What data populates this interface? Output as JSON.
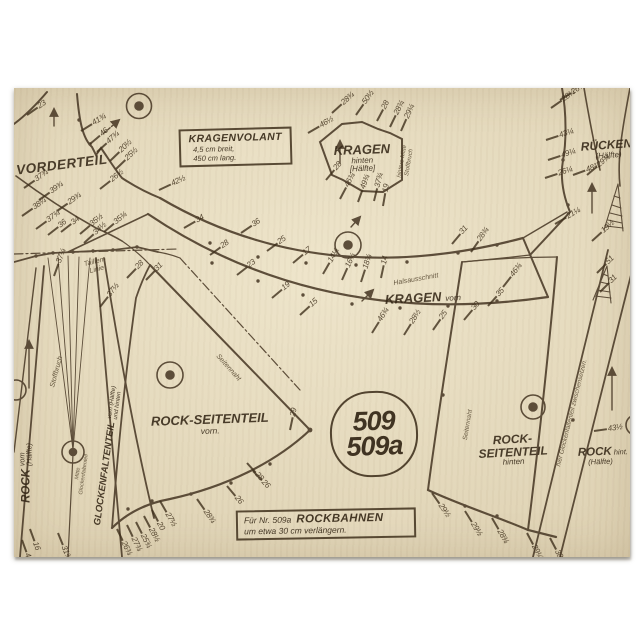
{
  "colors": {
    "paper": "#e7dcbd",
    "ink": "#4e3e2b"
  },
  "sheet": {
    "pattern_number": {
      "line1": "509",
      "line2": "509a"
    },
    "boxes": {
      "kragenvolant": {
        "title": "KRAGENVOLANT",
        "line1": "4,5 cm breit,",
        "line2": "450 cm lang."
      },
      "rockbahnen": {
        "prefix": "Für Nr. 509a",
        "title": "ROCKBAHNEN",
        "line2": "um etwa 30 cm verlängern."
      }
    },
    "pieces": {
      "vorderteil": {
        "label": "VORDERTEIL"
      },
      "kragen_hinten": {
        "label": "KRAGEN",
        "sub1": "hinten",
        "sub2": "[Hälfte]"
      },
      "kragen_vorn": {
        "label": "KRAGEN",
        "sub": "vorn"
      },
      "rueckenteil": {
        "label": "RÜCKENTEIL",
        "sub": "(Hälfte)"
      },
      "rock_seitenteil_vorn": {
        "label": "ROCK-SEITENTEIL",
        "sub": "vorn."
      },
      "rock_seitenteil_hinten": {
        "line1": "ROCK-",
        "line2": "SEITENTEIL",
        "sub": "hinten"
      },
      "rock_vorn": {
        "label": "ROCK",
        "sub1": "vorn",
        "sub2": "(Hälfte)"
      },
      "rock_hinten": {
        "label": "ROCK",
        "sub1": "hint.",
        "sub2": "(Hälfte)"
      },
      "glockenfaltenteil": {
        "label": "GLOCKENFALTENTEIL",
        "sub1": "vorn (Hälfte)",
        "sub2": "und hinten"
      }
    },
    "annotations": {
      "taillen_linie1": "Taillen-",
      "taillen_linie2": "Linie",
      "halsausschnitt": "Halsausschnitt",
      "stoffbruch": "Stoffbruch",
      "seitennaht_vorn": "Seitennaht",
      "seitennaht_hinten": "Seitennaht",
      "hintere_mitte1": "hintere Mitte",
      "hintere_mitte2": "Stoffbruch",
      "zwischensetzen": "hier Glockenfaltenteil zwischensetzen.",
      "mitte_glocke1": "Mitte",
      "mitte_glocke2": "Glockenfaltenteil"
    },
    "measure_marks": [
      [
        27,
        111,
        -35,
        "23"
      ],
      [
        81,
        127,
        -32,
        "41¾"
      ],
      [
        90,
        140,
        -40,
        "46"
      ],
      [
        97,
        148,
        -42,
        "47¾"
      ],
      [
        110,
        157,
        -44,
        "20½"
      ],
      [
        116,
        165,
        -44,
        "25½"
      ],
      [
        100,
        185,
        -38,
        "26½"
      ],
      [
        24,
        184,
        -35,
        "37¾"
      ],
      [
        39,
        196,
        -35,
        "39¾"
      ],
      [
        57,
        207,
        -35,
        "29¾"
      ],
      [
        22,
        212,
        -35,
        "38¼"
      ],
      [
        159,
        186,
        -25,
        "42½"
      ],
      [
        184,
        224,
        -30,
        "34"
      ],
      [
        36,
        225,
        -36,
        "37¾"
      ],
      [
        48,
        231,
        -38,
        "36"
      ],
      [
        61,
        228,
        -38,
        "34"
      ],
      [
        80,
        230,
        -40,
        "35½"
      ],
      [
        84,
        239,
        -42,
        "34½"
      ],
      [
        104,
        228,
        -40,
        "35¾"
      ],
      [
        54,
        272,
        -70,
        "37¼"
      ],
      [
        127,
        274,
        -46,
        "28"
      ],
      [
        146,
        276,
        -46,
        "31"
      ],
      [
        100,
        303,
        -52,
        "37½"
      ],
      [
        241,
        229,
        -34,
        "36"
      ],
      [
        210,
        251,
        -36,
        "28"
      ],
      [
        267,
        247,
        -36,
        "25"
      ],
      [
        237,
        271,
        -38,
        "23"
      ],
      [
        293,
        259,
        -40,
        "17"
      ],
      [
        272,
        294,
        -40,
        "19"
      ],
      [
        300,
        311,
        -42,
        "15"
      ],
      [
        323,
        270,
        -60,
        "14¼"
      ],
      [
        342,
        276,
        -66,
        "16¼"
      ],
      [
        361,
        278,
        -72,
        "18¾"
      ],
      [
        381,
        274,
        -78,
        "14"
      ],
      [
        452,
        240,
        -50,
        "31"
      ],
      [
        471,
        248,
        -55,
        "28¾"
      ],
      [
        372,
        329,
        -58,
        "46¾"
      ],
      [
        404,
        331,
        -58,
        "28½"
      ],
      [
        433,
        326,
        -55,
        "25"
      ],
      [
        464,
        316,
        -50,
        "30"
      ],
      [
        488,
        302,
        -48,
        "35"
      ],
      [
        503,
        283,
        -52,
        "46¾"
      ],
      [
        332,
        109,
        -42,
        "28¾"
      ],
      [
        356,
        111,
        -55,
        "50½"
      ],
      [
        377,
        117,
        -62,
        "28"
      ],
      [
        390,
        123,
        -64,
        "28¾"
      ],
      [
        401,
        127,
        -66,
        "29¼"
      ],
      [
        308,
        129,
        -30,
        "46½"
      ],
      [
        326,
        176,
        -50,
        "28"
      ],
      [
        340,
        195,
        -62,
        "46¾"
      ],
      [
        358,
        198,
        -70,
        "49¾"
      ],
      [
        374,
        197,
        -76,
        "37¾"
      ],
      [
        383,
        202,
        -80,
        "19"
      ],
      [
        551,
        104,
        -35,
        "28¼"
      ],
      [
        560,
        96,
        -32,
        "26¼"
      ],
      [
        546,
        136,
        -18,
        "43¼"
      ],
      [
        548,
        156,
        -18,
        "49¼"
      ],
      [
        545,
        174,
        -18,
        "26¼"
      ],
      [
        573,
        171,
        -20,
        "48¾"
      ],
      [
        555,
        220,
        -30,
        "21¼"
      ],
      [
        587,
        171,
        -40,
        "29¾"
      ],
      [
        592,
        237,
        -42,
        "19½"
      ],
      [
        597,
        269,
        -45,
        "51"
      ],
      [
        600,
        288,
        -45,
        "31"
      ],
      [
        160,
        497,
        60,
        "27½"
      ],
      [
        152,
        506,
        62,
        "20"
      ],
      [
        144,
        512,
        62,
        "28½"
      ],
      [
        136,
        518,
        63,
        "25¾"
      ],
      [
        127,
        521,
        64,
        "27¾"
      ],
      [
        117,
        525,
        64,
        "26¾"
      ],
      [
        197,
        495,
        55,
        "28¾"
      ],
      [
        227,
        482,
        50,
        "26"
      ],
      [
        253,
        467,
        46,
        "26"
      ],
      [
        58,
        529,
        68,
        "31¾"
      ],
      [
        30,
        525,
        70,
        "16"
      ],
      [
        22,
        536,
        70,
        "40¾"
      ],
      [
        290,
        426,
        -78,
        "29"
      ],
      [
        247,
        459,
        48,
        "28"
      ],
      [
        432,
        489,
        55,
        "29½"
      ],
      [
        465,
        507,
        58,
        "29½"
      ],
      [
        492,
        514,
        60,
        "28¾"
      ],
      [
        527,
        529,
        62,
        "29¼"
      ],
      [
        550,
        534,
        62,
        "38½"
      ],
      [
        594,
        427,
        -8,
        "43½"
      ]
    ]
  }
}
